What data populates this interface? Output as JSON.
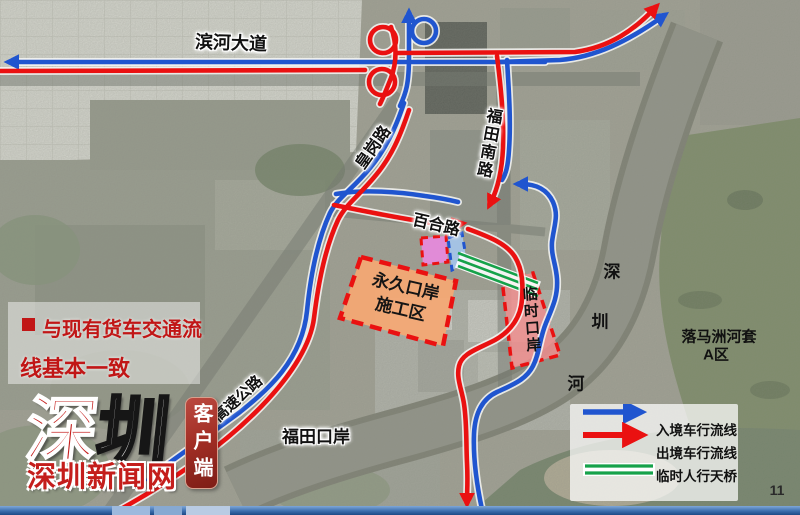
{
  "page_number": "11",
  "colors": {
    "inbound_blue": "#2055cf",
    "outbound_red": "#ea1111",
    "footbridge_green": "#16a24a",
    "construction_orange": "#f3a874",
    "temp_port_pink": "#ef8e8e",
    "pink_box": "#e989df",
    "blue_box": "#a5c6ec",
    "annotation_red": "#c11616"
  },
  "annotation": {
    "line1": "与现有货车交通流",
    "line2": "线基本一致"
  },
  "map": {
    "road_labels": {
      "binhe": "滨河大道",
      "huanggang": "皇岗路",
      "futian_south": "福田南路",
      "baihe": "百合路",
      "expressway": "高速公路",
      "futian_port": "福田口岸"
    },
    "river": {
      "chars": [
        "深",
        "圳",
        "河"
      ]
    },
    "areas": {
      "permanent_port_line1": "永久口岸",
      "permanent_port_line2": "施工区",
      "temporary_port": "临时口岸",
      "loop_line1": "落马洲河套",
      "loop_line2": "A区"
    }
  },
  "legend": {
    "items": [
      {
        "label": "入境车行流线"
      },
      {
        "label": "出境车行流线"
      },
      {
        "label": "临时人行天桥"
      }
    ]
  },
  "logo": {
    "mark_char1": "深",
    "mark_char2": "圳",
    "site_name": "深圳新闻网",
    "client_badge": "客户端"
  }
}
